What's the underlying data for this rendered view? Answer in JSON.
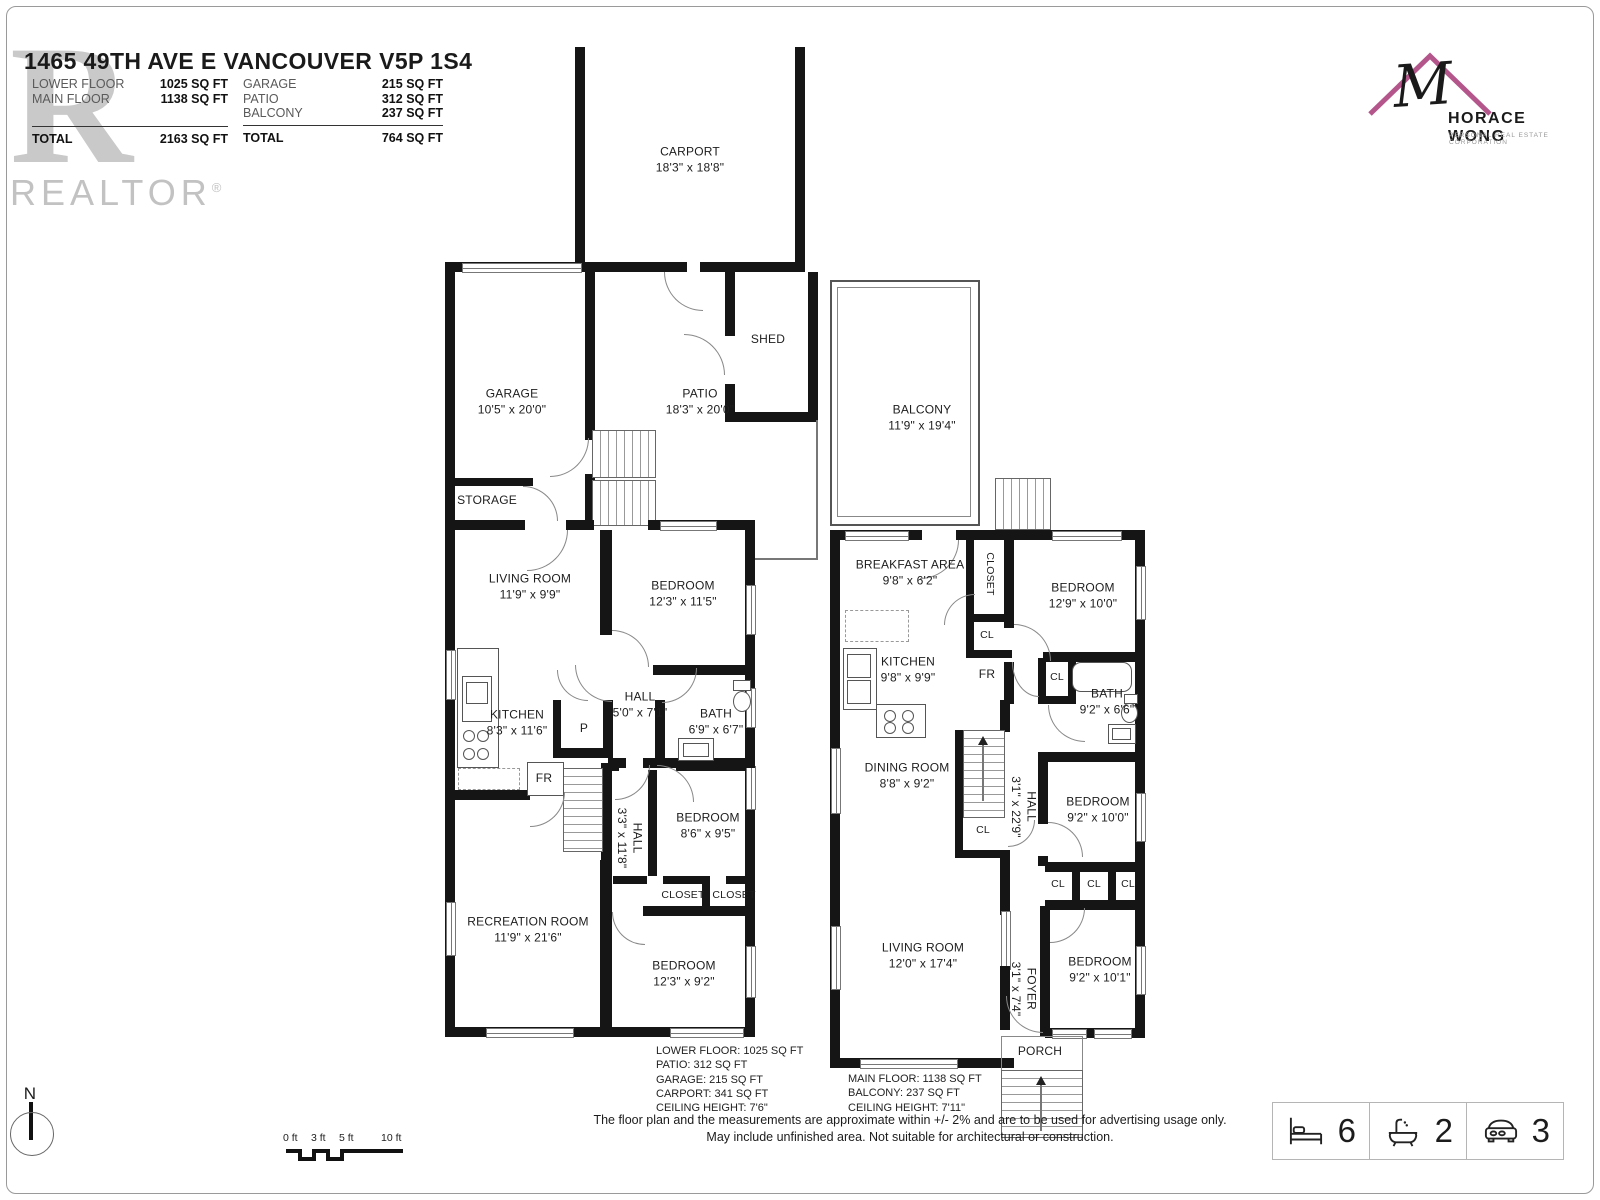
{
  "header": {
    "title": "1465 49TH AVE E VANCOUVER V5P 1S4",
    "left_table": {
      "rows": [
        {
          "label": "LOWER FLOOR",
          "value": "1025 SQ FT"
        },
        {
          "label": "MAIN FLOOR",
          "value": "1138 SQ FT"
        }
      ],
      "total_label": "TOTAL",
      "total_value": "2163 SQ FT"
    },
    "right_table": {
      "rows": [
        {
          "label": "GARAGE",
          "value": "215 SQ FT"
        },
        {
          "label": "PATIO",
          "value": "312 SQ FT"
        },
        {
          "label": "BALCONY",
          "value": "237 SQ FT"
        }
      ],
      "total_label": "TOTAL",
      "total_value": "764 SQ FT"
    }
  },
  "branding": {
    "realtor_big_r": "R",
    "realtor_wordmark": "REALTOR",
    "registered_mark": "®",
    "agent_monogram": "M",
    "agent_name": "HORACE WONG",
    "agent_tagline": "PERSONAL REAL ESTATE CORPORATION",
    "roof_color": "#b4568c"
  },
  "lower_floor": {
    "rooms": {
      "carport": {
        "name": "CARPORT",
        "dims": "18'3\" x 18'8\""
      },
      "garage": {
        "name": "GARAGE",
        "dims": "10'5\" x 20'0\""
      },
      "patio": {
        "name": "PATIO",
        "dims": "18'3\" x 20'0\""
      },
      "shed": {
        "name": "SHED"
      },
      "storage": {
        "name": "STORAGE"
      },
      "living_room": {
        "name": "LIVING ROOM",
        "dims": "11'9\" x 9'9\""
      },
      "bedroom1": {
        "name": "BEDROOM",
        "dims": "12'3\" x 11'5\""
      },
      "kitchen": {
        "name": "KITCHEN",
        "dims": "8'3\" x 11'6\""
      },
      "hall1": {
        "name": "HALL",
        "dims": "5'0\" x 7'1\""
      },
      "bath": {
        "name": "BATH",
        "dims": "6'9\" x 6'7\""
      },
      "pantry": {
        "name": "P"
      },
      "fridge": {
        "name": "FR"
      },
      "hall2": {
        "name": "HALL",
        "dims": "3'3\" x 11'8\""
      },
      "bedroom2": {
        "name": "BEDROOM",
        "dims": "8'6\" x 9'5\""
      },
      "closet1": {
        "name": "CLOSET"
      },
      "closet2": {
        "name": "CLOSET"
      },
      "recreation": {
        "name": "RECREATION ROOM",
        "dims": "11'9\" x 21'6\""
      },
      "bedroom3": {
        "name": "BEDROOM",
        "dims": "12'3\" x 9'2\""
      }
    },
    "notes": [
      "LOWER FLOOR: 1025 SQ FT",
      "PATIO: 312 SQ FT",
      "GARAGE: 215 SQ FT",
      "CARPORT: 341 SQ FT",
      "CEILING HEIGHT: 7'6\""
    ]
  },
  "main_floor": {
    "rooms": {
      "balcony": {
        "name": "BALCONY",
        "dims": "11'9\" x 19'4\""
      },
      "breakfast": {
        "name": "BREAKFAST AREA",
        "dims": "9'8\" x 6'2\""
      },
      "closet": {
        "name": "CLOSET"
      },
      "bedroom1": {
        "name": "BEDROOM",
        "dims": "12'9\" x 10'0\""
      },
      "cl1": {
        "name": "CL"
      },
      "kitchen": {
        "name": "KITCHEN",
        "dims": "9'8\" x 9'9\""
      },
      "fridge": {
        "name": "FR"
      },
      "cl2": {
        "name": "CL"
      },
      "bath": {
        "name": "BATH",
        "dims": "9'2\" x 6'6\""
      },
      "dining": {
        "name": "DINING ROOM",
        "dims": "8'8\" x 9'2\""
      },
      "cl3": {
        "name": "CL"
      },
      "hall": {
        "name": "HALL",
        "dims": "3'1\" x 22'9\""
      },
      "bedroom2": {
        "name": "BEDROOM",
        "dims": "9'2\" x 10'0\""
      },
      "cl4": {
        "name": "CL"
      },
      "cl5": {
        "name": "CL"
      },
      "cl6": {
        "name": "CL"
      },
      "living_room": {
        "name": "LIVING ROOM",
        "dims": "12'0\" x 17'4\""
      },
      "foyer": {
        "name": "FOYER",
        "dims": "3'1\" x 7'4\""
      },
      "bedroom3": {
        "name": "BEDROOM",
        "dims": "9'2\" x 10'1\""
      },
      "porch": {
        "name": "PORCH"
      }
    },
    "notes": [
      "MAIN FLOOR: 1138 SQ FT",
      "BALCONY: 237 SQ FT",
      "CEILING HEIGHT: 7'11\""
    ]
  },
  "footer": {
    "north_label": "N",
    "scale_ticks": [
      "0 ft",
      "3 ft",
      "5 ft",
      "10 ft"
    ],
    "disclaimer_line1": "The floor plan and the measurements are approximate within +/- 2% and are to be used for advertising usage only.",
    "disclaimer_line2": "May include unfinished area. Not suitable for architectural or construction.",
    "stats": {
      "beds": "6",
      "baths": "2",
      "cars": "3"
    }
  }
}
